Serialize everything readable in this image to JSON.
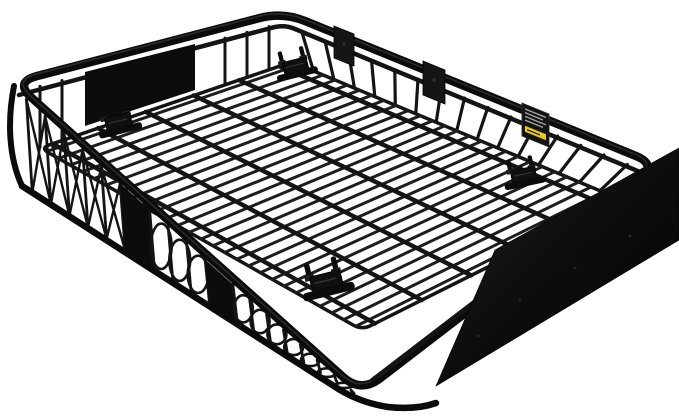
{
  "meta": {
    "description": "Product photo of a black steel roof-mount cargo basket rack with mesh floor, side rails, four U-bolt mounting clamps and a wind fairing, on a plain white background",
    "background": "#ffffff"
  },
  "colors": {
    "steel": "#141414",
    "steel_dark": "#0b0b0b",
    "steel_mid": "#1d1d1d",
    "highlight": "#4a4a4a",
    "panel": "#0c0c0c",
    "fairing_hi": "#262626",
    "fairing_mid": "#0e0e0e",
    "fairing_lo": "#030303",
    "label_bg": "#131313",
    "label_border": "#2b2b2b",
    "label_text": "#c7c7c7",
    "label_stripe": "#e8c822",
    "label_stripe_text": "#262100",
    "bolt": "#2e2e2e"
  },
  "mesh": {
    "cross_bar_count": 27,
    "long_bar_count": 6
  },
  "right_wall": {
    "bar_count": 16,
    "plate_count": 2
  },
  "far_wall": {
    "post_count": 5,
    "has_panel": true
  },
  "near_wall": {
    "segments": [
      {
        "type": "lattice",
        "from": 0.03,
        "to": 0.3
      },
      {
        "type": "panel",
        "from": 0.3,
        "to": 0.385
      },
      {
        "type": "rings",
        "from": 0.385,
        "to": 0.545
      },
      {
        "type": "panel",
        "from": 0.545,
        "to": 0.625
      },
      {
        "type": "rings",
        "from": 0.625,
        "to": 0.965
      }
    ]
  },
  "clamps": {
    "count": 4
  },
  "label": {
    "text_lines": 4,
    "legible": false,
    "has_stripe": true
  },
  "fairing": {
    "screw_count": 4
  }
}
